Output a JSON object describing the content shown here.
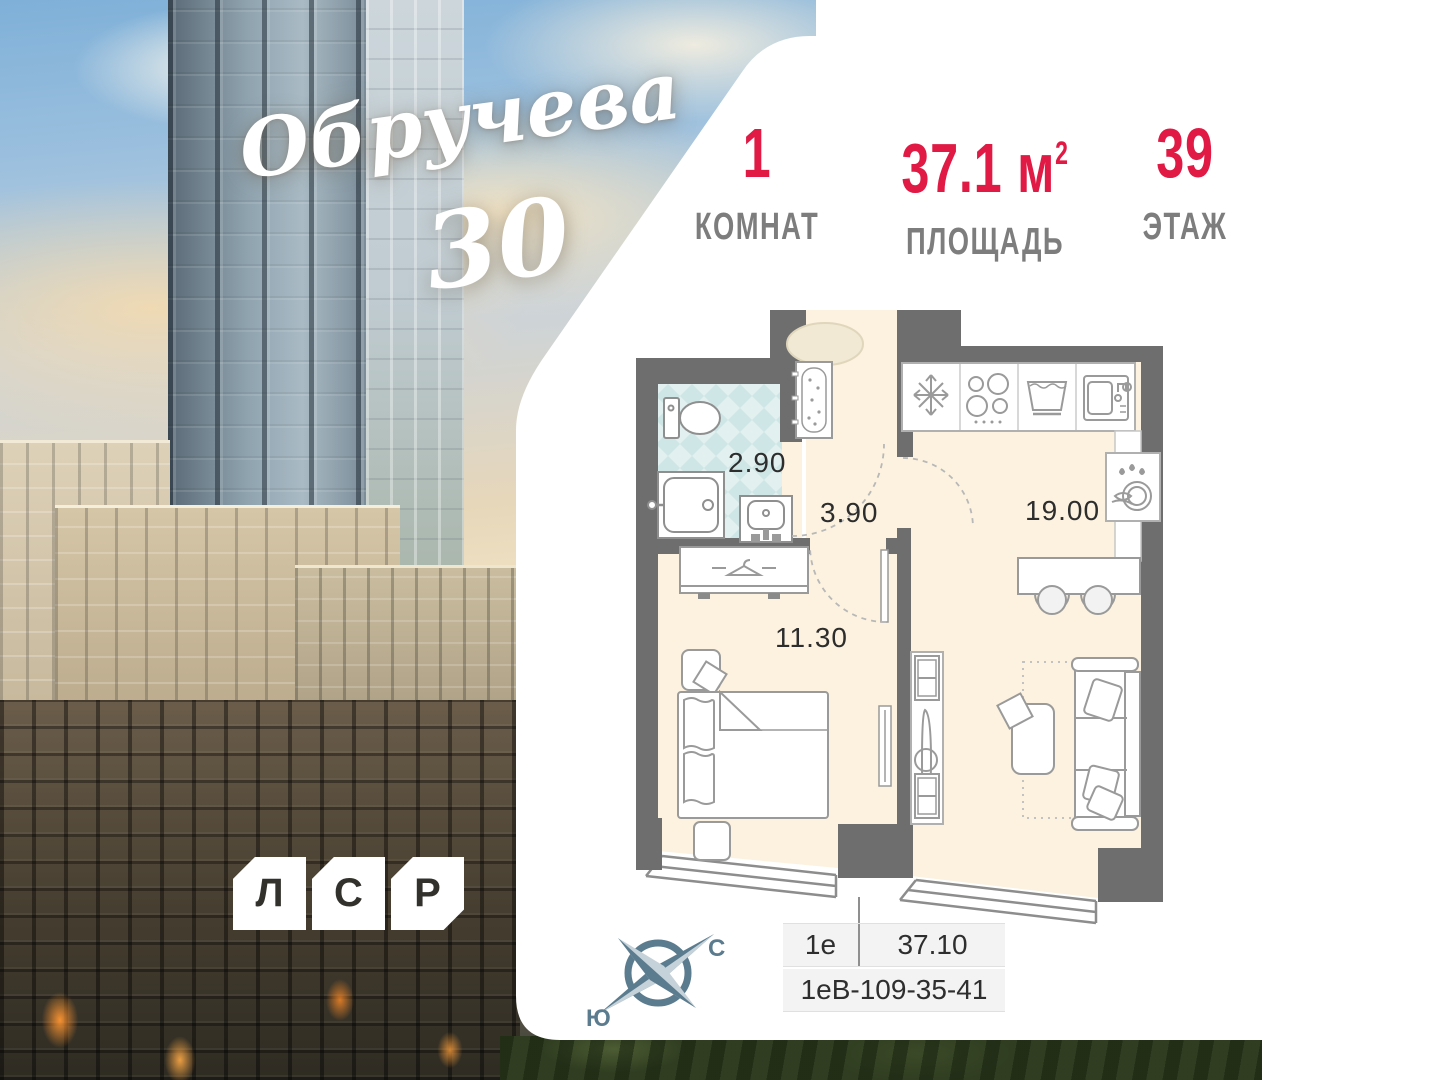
{
  "project": {
    "name_script": "Обручева",
    "number": "30"
  },
  "developer": {
    "letters": [
      "Л",
      "С",
      "Р"
    ]
  },
  "stats": {
    "rooms": {
      "value": "1",
      "label": "КОМНАТ"
    },
    "area": {
      "value": "37.1",
      "unit": "м",
      "sup": "2",
      "label": "ПЛОЩАДЬ"
    },
    "floor": {
      "value": "39",
      "label": "ЭТАЖ"
    }
  },
  "plan": {
    "rooms": [
      {
        "name": "bathroom",
        "area": "2.90"
      },
      {
        "name": "hallway",
        "area": "3.90"
      },
      {
        "name": "kitchen-living",
        "area": "19.00"
      },
      {
        "name": "bedroom",
        "area": "11.30"
      }
    ]
  },
  "compass": {
    "north": "С",
    "south": "Ю"
  },
  "info_table": {
    "type": "1е",
    "area": "37.10",
    "code": "1еВ-109-35-41"
  },
  "colors": {
    "accent_red": "#e01a44",
    "label_gray": "#7d7d7d",
    "wall_gray": "#6e6e6e",
    "floor_cream": "#fcf2df",
    "tile_teal": "#cfe6e6",
    "compass_slate": "#5b7c8e"
  }
}
